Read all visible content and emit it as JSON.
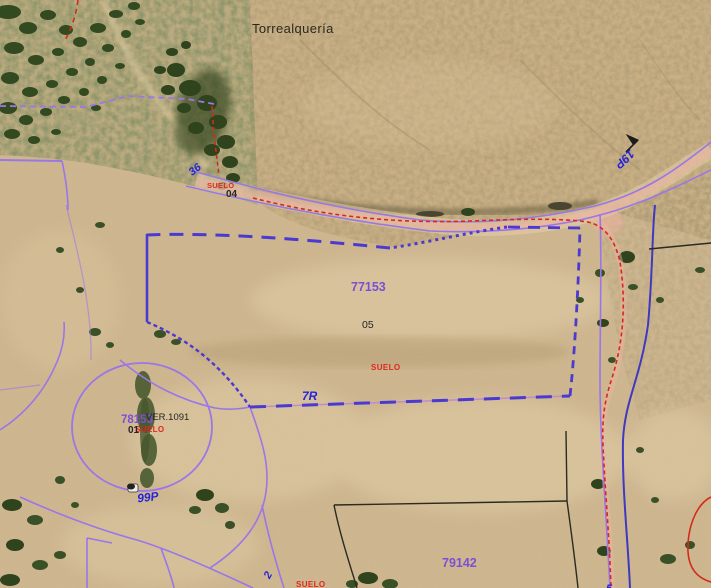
{
  "map": {
    "labels": {
      "place": "Torrealquería",
      "parcel_center": "77153",
      "parcel_center_sub": "05",
      "parcel_center_soil": "SUELO",
      "road_center": "7R",
      "parcel_left": "78153",
      "parcel_left_ver": "VER.1091",
      "parcel_left_sub": "01",
      "parcel_left_soil": "SUELO",
      "road_roundabout": "99P",
      "parcel_bottom": "79142",
      "road_upper": "36",
      "upper_sub": "04",
      "upper_soil": "SUELO",
      "road_right": "19P",
      "road_bottom_branch": "2",
      "bottom_soil": "SUELO",
      "right_partial": "5"
    },
    "colors": {
      "parcel_number_purple": "#7a4fd6",
      "boundary_blue": "#4a3ad0",
      "cadastral_purple": "#9a76e8",
      "road_label_blue": "#2525d8",
      "soil_red": "#e0281e",
      "black_label": "#262626",
      "red_line": "#d42a1a",
      "indigo_line": "#4038c0",
      "road_fill_pink": "#efb3a4",
      "black_line": "#2b2b20"
    }
  }
}
